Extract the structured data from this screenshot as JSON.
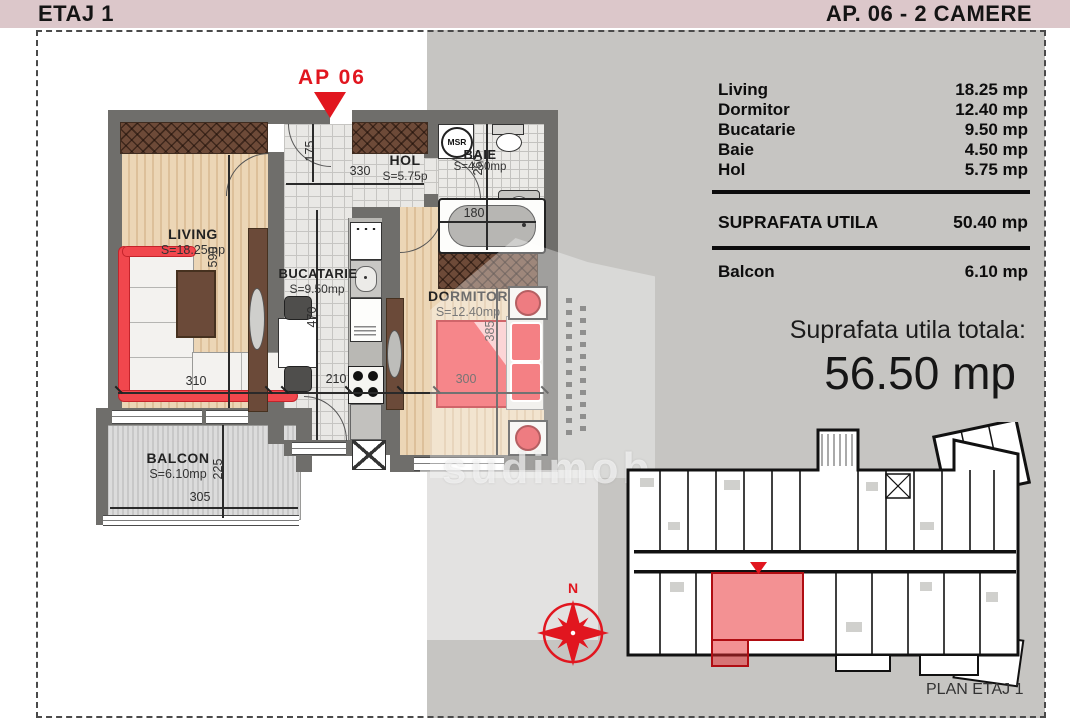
{
  "header": {
    "left_title": "ETAJ 1",
    "right_title": "AP. 06 - 2 CAMERE"
  },
  "marker": {
    "label": "AP 06"
  },
  "rooms": {
    "living": {
      "name": "LIVING",
      "area": "S=18.25mp"
    },
    "bucatarie": {
      "name": "BUCATARIE",
      "area": "S=9.50mp"
    },
    "hol": {
      "name": "HOL",
      "area": "S=5.75p"
    },
    "baie": {
      "name": "BAIE",
      "area": "S=4.50mp"
    },
    "dormitor": {
      "name": "DORMITOR",
      "area": "S=12.40mp"
    },
    "balcon": {
      "name": "BALCON",
      "area": "S=6.10mp"
    },
    "washer_label": "MSR"
  },
  "dims": {
    "living_w": "310",
    "living_h": "590",
    "hol_w": "330",
    "hol_h": "175",
    "kitchen_w": "210",
    "kitchen_h": "470",
    "bedroom_w": "300",
    "bedroom_h": "385",
    "bath_h": "260",
    "tub_w": "180",
    "balcony_w": "305",
    "balcony_h": "225"
  },
  "area_table": {
    "rows": [
      {
        "label": "Living",
        "value": "18.25 mp"
      },
      {
        "label": "Dormitor",
        "value": "12.40 mp"
      },
      {
        "label": "Bucatarie",
        "value": "9.50 mp"
      },
      {
        "label": "Baie",
        "value": "4.50 mp"
      },
      {
        "label": "Hol",
        "value": "5.75 mp"
      }
    ],
    "total_label": "SUPRAFATA UTILA",
    "total_value": "50.40 mp",
    "balcony_label": "Balcon",
    "balcony_value": "6.10 mp"
  },
  "summary": {
    "title": "Suprafata utila totala:",
    "value": "56.50 mp"
  },
  "overview": {
    "caption": "PLAN ETAJ 1"
  },
  "compass": {
    "north_label": "N"
  },
  "watermark": {
    "text": "sudimob"
  },
  "colors": {
    "accent_red": "#e1161f",
    "header_pink": "#dcc7ca",
    "panel_gray": "#c6c5c2",
    "wall_gray": "#6f6e6b",
    "concrete_brown": "#6d4a38",
    "wood": "#ecd6b6",
    "bed_red": "#f2484e"
  }
}
